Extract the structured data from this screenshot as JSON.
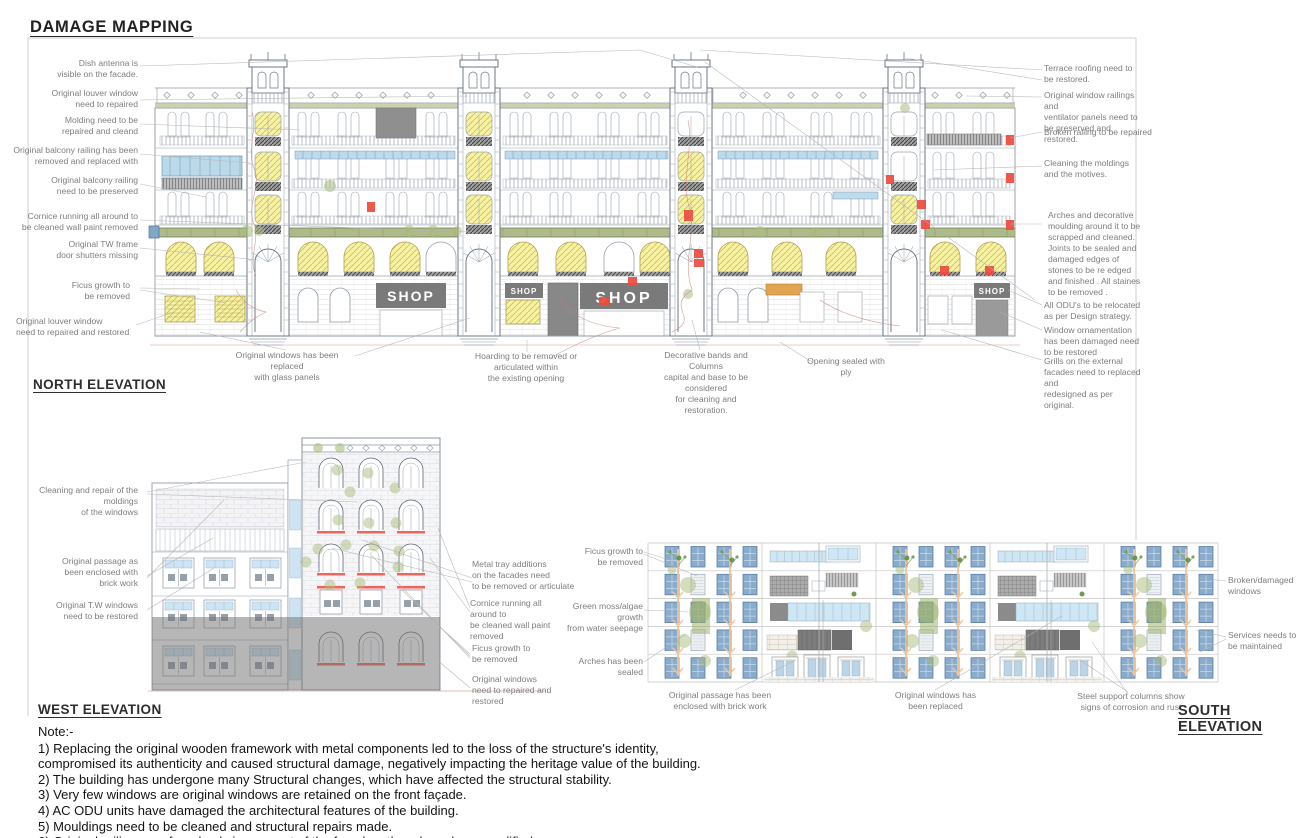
{
  "title": "DAMAGE MAPPING",
  "north": {
    "label": "NORTH ELEVATION",
    "shop_sign": "SHOP",
    "left_annotations": [
      "Dish antenna is\nvisible on the facade.",
      "Original louver window\nneed to repaired",
      "Molding need to be\nrepaired and cleand",
      "Original balcony railing has been\nremoved and replaced with",
      "Original balcony railing\nneed to be preserved",
      "Cornice running all around to\nbe cleaned wall paint removed",
      "Original TW frame\ndoor shutters missing",
      "Ficus growth to\nbe removed",
      "Original louver window\nneed to repaired and restored"
    ],
    "right_annotations": [
      "Terrace roofing need to\nbe restored.",
      "Original window railings and\nventilator panels need to\nbe preserved and restored.",
      "Broken railing to be repaired",
      "Cleaning the moldings\nand the motives.",
      "Arches and decorative\nmoulding around it to be\nscrapped and cleaned.\nJoints to be sealed and\ndamaged edges of\nstones to be re edged\nand finished . All staines\nto be removed .",
      "All ODU's to be relocated\nas per Design strategy.",
      "Window ornamentation\nhas been damaged need\nto be restored",
      "Grills on the external\nfacades need to replaced\nand\nredesigned as per\noriginal."
    ],
    "bottom_annotations": [
      "Original windows has been replaced\nwith glass panels",
      "Hoarding to be removed or articulated within\nthe existing opening",
      "Decorative bands and Columns\ncapital and base to be considered\nfor cleaning and restoration.",
      "Opening sealed with ply"
    ]
  },
  "west": {
    "label": "WEST ELEVATION",
    "left_annotations": [
      "Cleaning and repair of  the moldings\nof the windows",
      "Original passage as\nbeen enclosed with\nbrick work",
      "Original T.W windows\nneed to be restored"
    ],
    "right_annotations": [
      "Metal tray additions\non the facades need\nto be removed or articulate",
      "Cornice running all around to\nbe cleaned wall paint removed",
      "Ficus growth to\nbe removed",
      "Original windows\nneed to repaired and\nrestored"
    ]
  },
  "south": {
    "label": "SOUTH ELEVATION",
    "left_annotations": [
      "Ficus growth to\nbe removed",
      "Green moss/algae growth\nfrom water seepage",
      "Arches has been\nsealed"
    ],
    "right_annotations": [
      "Broken/damaged windows",
      "Services needs to\nbe maintained"
    ],
    "bottom_annotations": [
      "Original passage has been\nenclosed with brick work",
      "Original windows has\nbeen replaced",
      "Steel support columns show\nsigns of corrosion and rust"
    ]
  },
  "notes": {
    "heading": "Note:-",
    "items": [
      "1) Replacing the original wooden framework with metal components led to the loss of the structure's identity,\ncompromised its authenticity and caused structural damage, negatively impacting the heritage value of the building.",
      "2) The building has undergone many Structural changes, which have affected the structural stability.",
      "3) Very few windows are original windows are retained on the front façade.",
      "4) AC ODU units have damaged the architectural features of the building.",
      "5) Mouldings need to be cleaned and structural repairs made.",
      "6) Original railings are found only in one part of the façade; others have been modified."
    ]
  },
  "colors": {
    "highlight_yellow": "#f7f2a3",
    "glass_blue": "#bcd9ea",
    "damage_red": "#ee4b3e",
    "growth_green": "#a9bc7d",
    "branch_orange": "#eec49c",
    "window_blue": "#8aabcb",
    "overlay_gray": "#6e6e6e",
    "shop_gray": "#7a7a7a",
    "cornice_green": "#9fae74",
    "line_gray": "#98a2ae"
  }
}
